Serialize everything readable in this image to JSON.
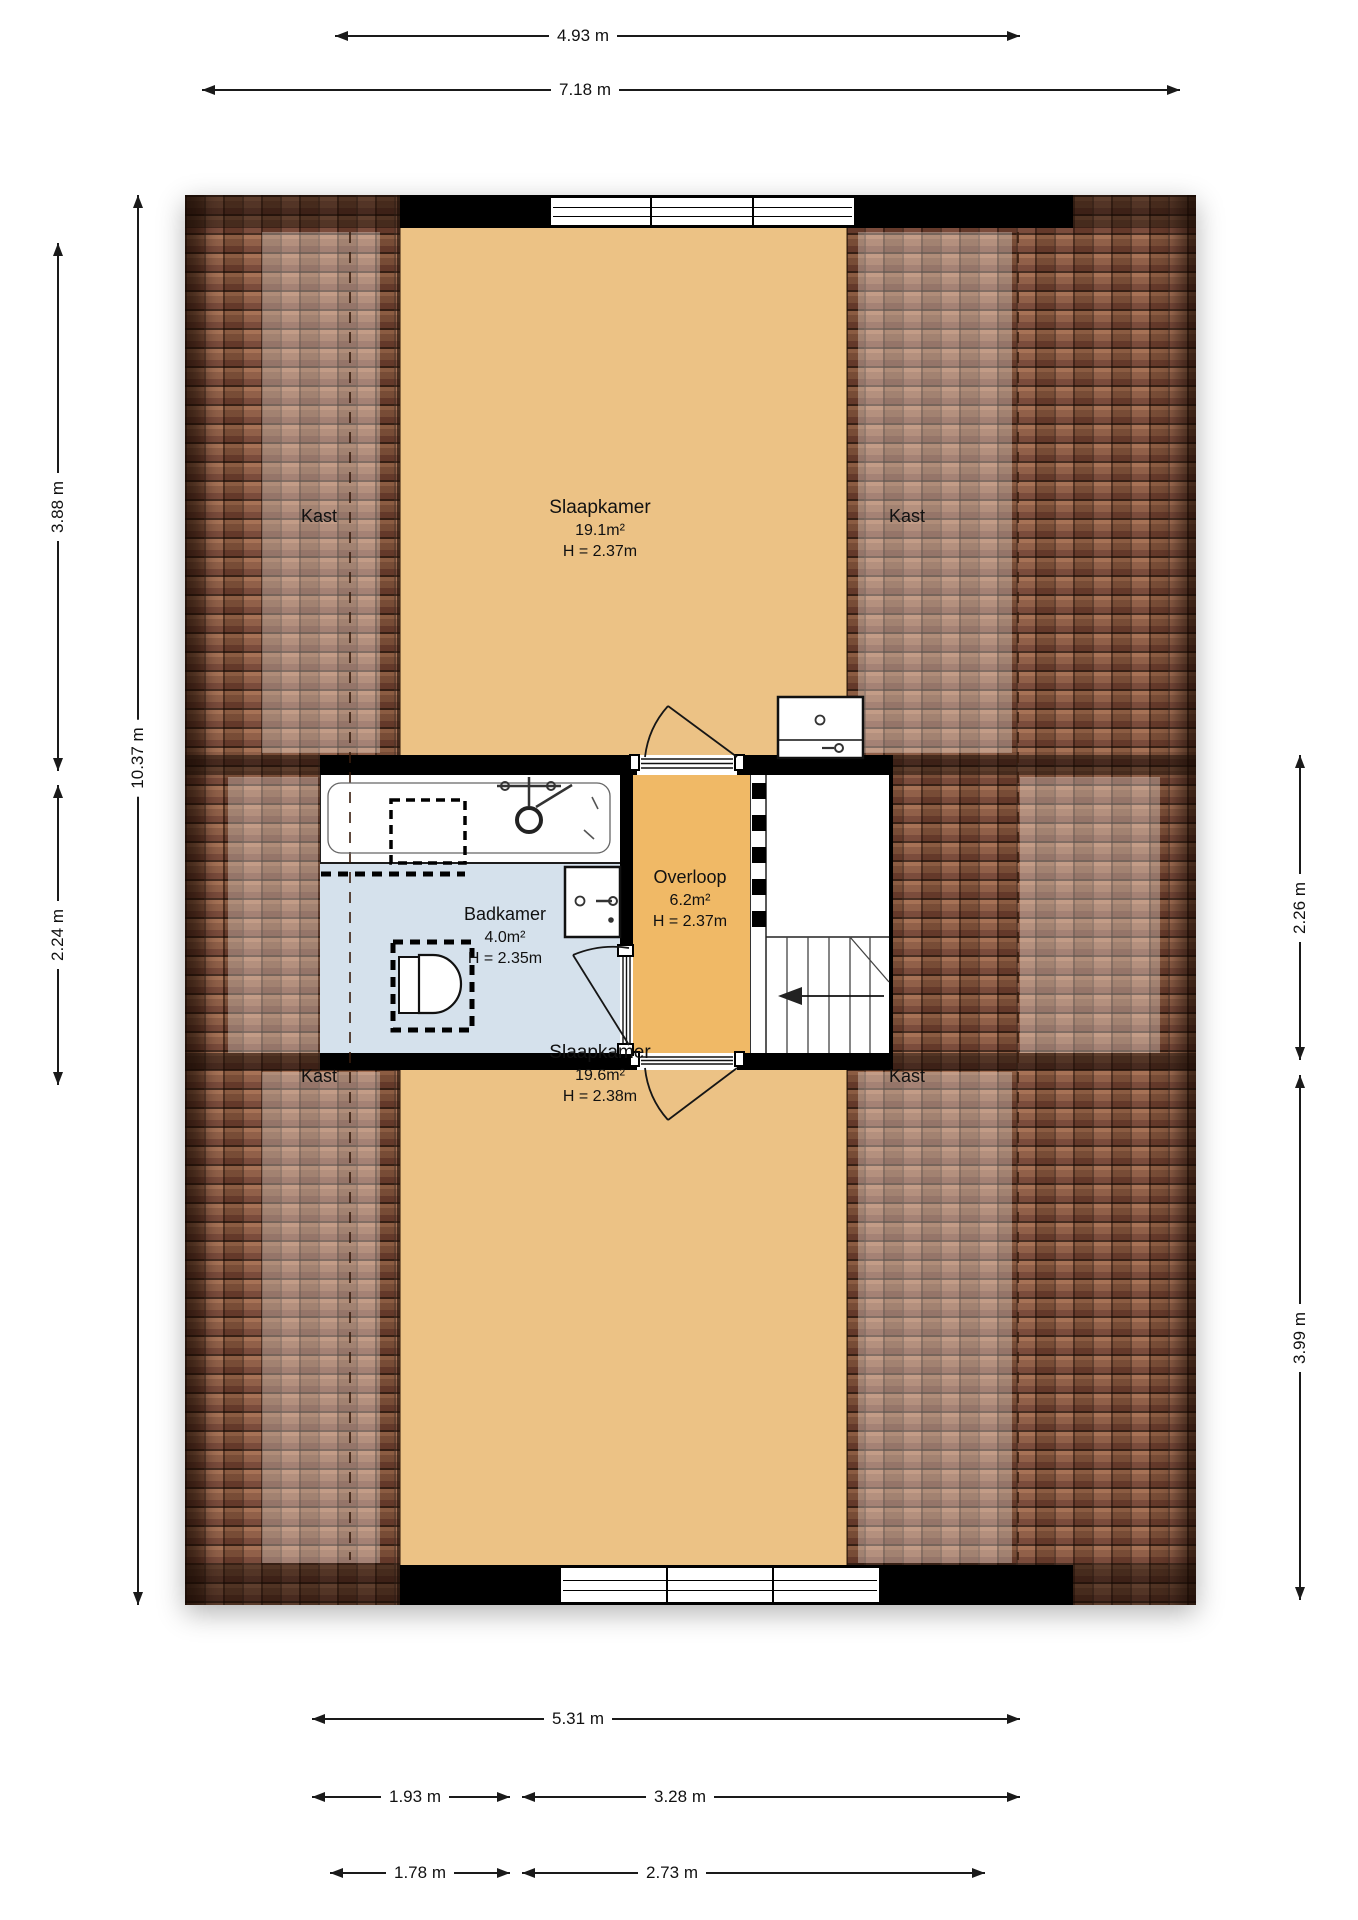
{
  "plan_type": "floor-plan",
  "rooms": {
    "slaapkamer1": {
      "name": "Slaapkamer",
      "area": "19.1m²",
      "height": "H = 2.37m"
    },
    "slaapkamer2": {
      "name": "Slaapkamer",
      "area": "19.6m²",
      "height": "H = 2.38m"
    },
    "badkamer": {
      "name": "Badkamer",
      "area": "4.0m²",
      "height": "H = 2.35m"
    },
    "overloop": {
      "name": "Overloop",
      "area": "6.2m²",
      "height": "H = 2.37m"
    }
  },
  "closets": {
    "top_left": "Kast",
    "top_right": "Kast",
    "bottom_left": "Kast",
    "bottom_right": "Kast"
  },
  "dimensions": {
    "top": {
      "inner": "4.93 m",
      "outer": "7.18 m"
    },
    "left": {
      "top": "3.88 m",
      "middle": "2.24 m",
      "total": "10.37 m"
    },
    "right": {
      "middle": "2.26 m",
      "bottom": "3.99 m"
    },
    "bottom": {
      "row1": "5.31 m",
      "row2_left": "1.93 m",
      "row2_right": "3.28 m",
      "row3_left": "1.78 m",
      "row3_right": "2.73 m"
    }
  },
  "colors": {
    "bedroom_floor": "#ecc285",
    "landing_floor": "#f0b966",
    "bathroom_floor": "#d5e1ec",
    "roof_tiles": "#85523b",
    "wall": "#000000"
  }
}
